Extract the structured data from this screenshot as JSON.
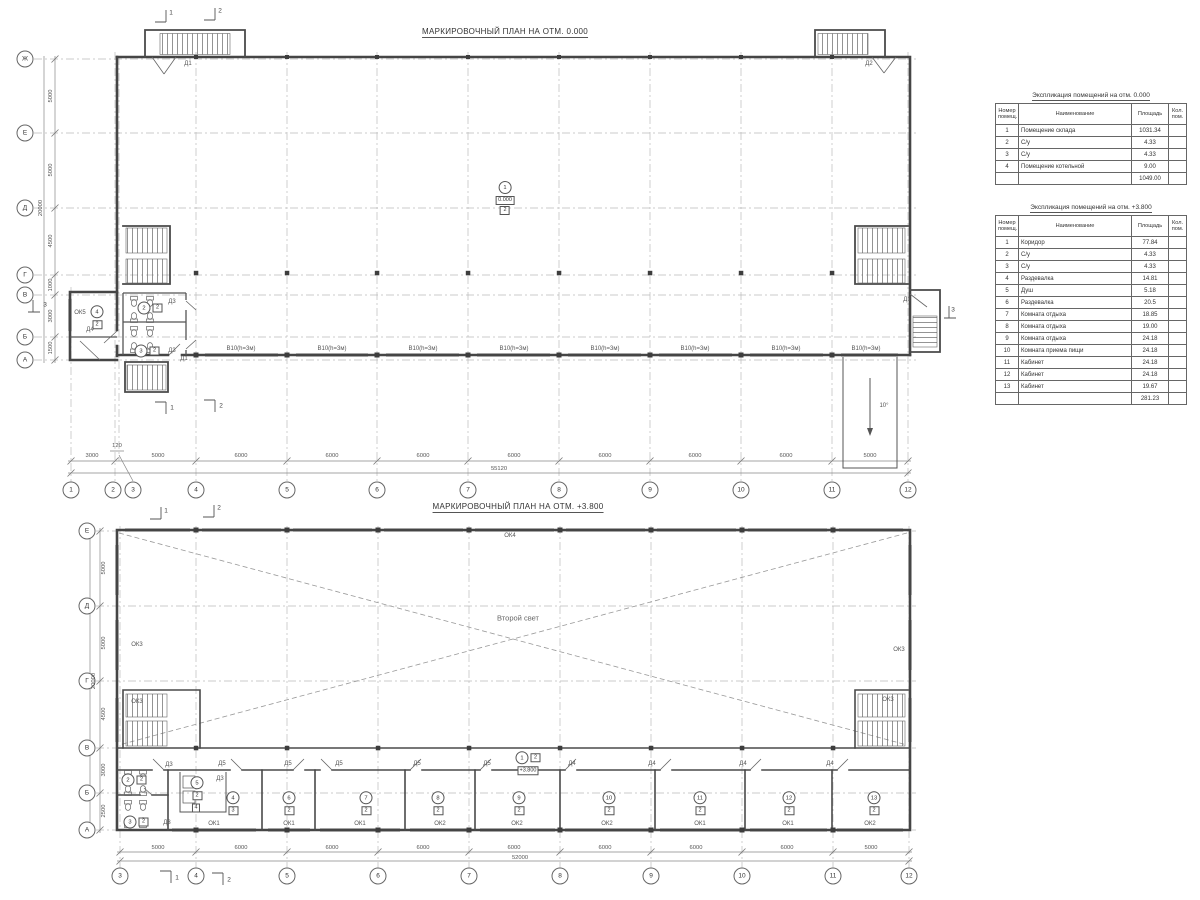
{
  "plan1": {
    "title": "МАРКИРОВОЧНЫЙ ПЛАН НА ОТМ. 0.000",
    "grid_rows": [
      {
        "t": "Ж",
        "x": 25,
        "y": 59
      },
      {
        "t": "Е",
        "x": 25,
        "y": 133
      },
      {
        "t": "Д",
        "x": 25,
        "y": 208
      },
      {
        "t": "Г",
        "x": 25,
        "y": 275
      },
      {
        "t": "В",
        "x": 25,
        "y": 295
      },
      {
        "t": "Б",
        "x": 25,
        "y": 337
      },
      {
        "t": "А",
        "x": 25,
        "y": 360
      }
    ],
    "grid_cols": [
      {
        "t": "1",
        "x": 71,
        "y": 490
      },
      {
        "t": "2",
        "x": 113,
        "y": 490
      },
      {
        "t": "3",
        "x": 133,
        "y": 490
      },
      {
        "t": "4",
        "x": 196,
        "y": 490
      },
      {
        "t": "5",
        "x": 287,
        "y": 490
      },
      {
        "t": "6",
        "x": 377,
        "y": 490
      },
      {
        "t": "7",
        "x": 468,
        "y": 490
      },
      {
        "t": "8",
        "x": 559,
        "y": 490
      },
      {
        "t": "9",
        "x": 650,
        "y": 490
      },
      {
        "t": "10",
        "x": 741,
        "y": 490
      },
      {
        "t": "11",
        "x": 832,
        "y": 490
      },
      {
        "t": "12",
        "x": 908,
        "y": 490
      }
    ],
    "dims_h": [
      {
        "t": "3000",
        "x": 92,
        "y": 456
      },
      {
        "t": "120",
        "x": 117,
        "y": 446
      },
      {
        "t": "5000",
        "x": 158,
        "y": 456
      },
      {
        "t": "6000",
        "x": 241,
        "y": 456
      },
      {
        "t": "6000",
        "x": 332,
        "y": 456
      },
      {
        "t": "6000",
        "x": 423,
        "y": 456
      },
      {
        "t": "6000",
        "x": 514,
        "y": 456
      },
      {
        "t": "6000",
        "x": 605,
        "y": 456
      },
      {
        "t": "6000",
        "x": 695,
        "y": 456
      },
      {
        "t": "6000",
        "x": 786,
        "y": 456
      },
      {
        "t": "5000",
        "x": 870,
        "y": 456
      }
    ],
    "total_h": {
      "t": "55120",
      "x": 499,
      "y": 469
    },
    "dims_v": [
      {
        "t": "5000",
        "x": 51,
        "y": 96
      },
      {
        "t": "5000",
        "x": 51,
        "y": 170
      },
      {
        "t": "4500",
        "x": 51,
        "y": 241
      },
      {
        "t": "1000",
        "x": 51,
        "y": 285
      },
      {
        "t": "3000",
        "x": 51,
        "y": 316
      },
      {
        "t": "1500",
        "x": 51,
        "y": 348
      }
    ],
    "total_v": {
      "t": "20000",
      "x": 41,
      "y": 208
    },
    "labels": [
      {
        "t": "Д1",
        "x": 188,
        "y": 64
      },
      {
        "t": "Д2",
        "x": 869,
        "y": 64
      },
      {
        "t": "Д1",
        "x": 907,
        "y": 300
      },
      {
        "t": "Д1",
        "x": 184,
        "y": 359
      },
      {
        "t": "Д3",
        "x": 172,
        "y": 302
      },
      {
        "t": "Д3",
        "x": 172,
        "y": 351
      },
      {
        "t": "Д4",
        "x": 90,
        "y": 330
      },
      {
        "t": "ОК5",
        "x": 80,
        "y": 313
      },
      {
        "t": "10°",
        "x": 884,
        "y": 406
      },
      {
        "t": "В10(h=3м)",
        "x": 241,
        "y": 349
      },
      {
        "t": "В10(h=3м)",
        "x": 332,
        "y": 349
      },
      {
        "t": "В10(h=3м)",
        "x": 423,
        "y": 349
      },
      {
        "t": "В10(h=3м)",
        "x": 514,
        "y": 349
      },
      {
        "t": "В10(h=3м)",
        "x": 605,
        "y": 349
      },
      {
        "t": "В10(h=3м)",
        "x": 695,
        "y": 349
      },
      {
        "t": "В10(h=3м)",
        "x": 786,
        "y": 349
      },
      {
        "t": "В10(h=3м)",
        "x": 866,
        "y": 349
      }
    ],
    "flags": [
      {
        "t": "1",
        "x": 171,
        "y": 13
      },
      {
        "t": "2",
        "x": 220,
        "y": 11
      },
      {
        "t": "1",
        "x": 172,
        "y": 408
      },
      {
        "t": "2",
        "x": 221,
        "y": 406
      },
      {
        "t": "3",
        "x": 45,
        "y": 305
      },
      {
        "t": "3",
        "x": 953,
        "y": 310
      }
    ],
    "marks_v": [
      {
        "num": "4",
        "sub": "2",
        "x": 97,
        "y": 317
      }
    ],
    "marks_h": [
      {
        "num": "2",
        "sub": "2",
        "x": 150,
        "y": 308
      },
      {
        "num": "3",
        "sub": "2",
        "x": 147,
        "y": 351
      }
    ],
    "mark": {
      "num": "1",
      "elev": "0.000",
      "sub": "2"
    }
  },
  "plan2": {
    "title": "МАРКИРОВОЧНЫЙ ПЛАН НА ОТМ. +3.800",
    "grid_rows": [
      {
        "t": "Е",
        "x": 87,
        "y": 531
      },
      {
        "t": "Д",
        "x": 87,
        "y": 606
      },
      {
        "t": "Г",
        "x": 87,
        "y": 681
      },
      {
        "t": "В",
        "x": 87,
        "y": 748
      },
      {
        "t": "Б",
        "x": 87,
        "y": 793
      },
      {
        "t": "А",
        "x": 87,
        "y": 830
      }
    ],
    "grid_cols": [
      {
        "t": "3",
        "x": 120,
        "y": 876
      },
      {
        "t": "4",
        "x": 196,
        "y": 876
      },
      {
        "t": "5",
        "x": 287,
        "y": 876
      },
      {
        "t": "6",
        "x": 378,
        "y": 876
      },
      {
        "t": "7",
        "x": 469,
        "y": 876
      },
      {
        "t": "8",
        "x": 560,
        "y": 876
      },
      {
        "t": "9",
        "x": 651,
        "y": 876
      },
      {
        "t": "10",
        "x": 742,
        "y": 876
      },
      {
        "t": "11",
        "x": 833,
        "y": 876
      },
      {
        "t": "12",
        "x": 909,
        "y": 876
      }
    ],
    "dims_h": [
      {
        "t": "5000",
        "x": 158,
        "y": 848
      },
      {
        "t": "6000",
        "x": 241,
        "y": 848
      },
      {
        "t": "6000",
        "x": 332,
        "y": 848
      },
      {
        "t": "6000",
        "x": 423,
        "y": 848
      },
      {
        "t": "6000",
        "x": 514,
        "y": 848
      },
      {
        "t": "6000",
        "x": 605,
        "y": 848
      },
      {
        "t": "6000",
        "x": 696,
        "y": 848
      },
      {
        "t": "6000",
        "x": 787,
        "y": 848
      },
      {
        "t": "5000",
        "x": 871,
        "y": 848
      }
    ],
    "total_h": {
      "t": "52000",
      "x": 520,
      "y": 858
    },
    "dims_v": [
      {
        "t": "5000",
        "x": 104,
        "y": 568
      },
      {
        "t": "5000",
        "x": 104,
        "y": 643
      },
      {
        "t": "4500",
        "x": 104,
        "y": 714
      },
      {
        "t": "3000",
        "x": 104,
        "y": 770
      },
      {
        "t": "2500",
        "x": 104,
        "y": 811
      }
    ],
    "total_v": {
      "t": "20000",
      "x": 94,
      "y": 681
    },
    "labels": [
      {
        "t": "ОК4",
        "x": 510,
        "y": 536
      },
      {
        "t": "ОК3",
        "x": 137,
        "y": 645
      },
      {
        "t": "ОК3",
        "x": 137,
        "y": 702
      },
      {
        "t": "ОК3",
        "x": 888,
        "y": 700
      },
      {
        "t": "ОК3",
        "x": 899,
        "y": 650
      },
      {
        "t": "Д3",
        "x": 169,
        "y": 765
      },
      {
        "t": "Д3",
        "x": 220,
        "y": 779
      },
      {
        "t": "Д3",
        "x": 167,
        "y": 823
      },
      {
        "t": "Д5",
        "x": 222,
        "y": 764
      },
      {
        "t": "Д5",
        "x": 288,
        "y": 764
      },
      {
        "t": "Д5",
        "x": 339,
        "y": 764
      },
      {
        "t": "Д5",
        "x": 417,
        "y": 764
      },
      {
        "t": "Д5",
        "x": 487,
        "y": 764
      },
      {
        "t": "Д4",
        "x": 572,
        "y": 764
      },
      {
        "t": "Д4",
        "x": 652,
        "y": 764
      },
      {
        "t": "Д4",
        "x": 743,
        "y": 764
      },
      {
        "t": "Д4",
        "x": 830,
        "y": 764
      },
      {
        "t": "ОК1",
        "x": 214,
        "y": 824
      },
      {
        "t": "ОК1",
        "x": 289,
        "y": 824
      },
      {
        "t": "ОК1",
        "x": 360,
        "y": 824
      },
      {
        "t": "ОК2",
        "x": 440,
        "y": 824
      },
      {
        "t": "ОК2",
        "x": 517,
        "y": 824
      },
      {
        "t": "ОК2",
        "x": 607,
        "y": 824
      },
      {
        "t": "ОК1",
        "x": 700,
        "y": 824
      },
      {
        "t": "ОК1",
        "x": 788,
        "y": 824
      },
      {
        "t": "ОК2",
        "x": 870,
        "y": 824
      }
    ],
    "big_label": {
      "t": "Второй свет",
      "x": 518,
      "y": 618
    },
    "flags": [
      {
        "t": "1",
        "x": 166,
        "y": 511
      },
      {
        "t": "2",
        "x": 219,
        "y": 508
      },
      {
        "t": "1",
        "x": 177,
        "y": 878
      },
      {
        "t": "2",
        "x": 229,
        "y": 880
      }
    ],
    "marks_v": [
      {
        "num": "5",
        "sub": "2",
        "x": 197,
        "y": 788
      },
      {
        "num": "4",
        "sub": "3",
        "x": 233,
        "y": 803
      },
      {
        "num": "6",
        "sub": "2",
        "x": 289,
        "y": 803
      },
      {
        "num": "7",
        "sub": "2",
        "x": 366,
        "y": 803
      },
      {
        "num": "8",
        "sub": "2",
        "x": 438,
        "y": 803
      },
      {
        "num": "9",
        "sub": "2",
        "x": 519,
        "y": 803
      },
      {
        "num": "10",
        "sub": "2",
        "x": 609,
        "y": 803
      },
      {
        "num": "11",
        "sub": "2",
        "x": 700,
        "y": 803
      },
      {
        "num": "12",
        "sub": "2",
        "x": 789,
        "y": 803
      },
      {
        "num": "13",
        "sub": "2",
        "x": 874,
        "y": 803
      }
    ],
    "marks_h": [
      {
        "num": "2",
        "sub": "2",
        "x": 134,
        "y": 780
      },
      {
        "num": "3",
        "sub": "2",
        "x": 136,
        "y": 822
      }
    ],
    "boxes": [
      {
        "t": "4",
        "x": 196,
        "y": 808
      }
    ],
    "mark": {
      "num": "1",
      "sub": "2",
      "elev": "+3.800"
    }
  },
  "tables": [
    {
      "title": "Экспликация помещений на отм. 0.000",
      "headers": [
        "Номер помещ.",
        "Наименование",
        "Площадь",
        "Кол. пом."
      ],
      "rows": [
        [
          "1",
          "Помещение склада",
          "1031.34",
          ""
        ],
        [
          "2",
          "С/у",
          "4.33",
          ""
        ],
        [
          "3",
          "С/у",
          "4.33",
          ""
        ],
        [
          "4",
          "Помещение котельной",
          "9.00",
          ""
        ]
      ],
      "total": "1049.00"
    },
    {
      "title": "Экспликация помещений на отм. +3.800",
      "headers": [
        "Номер помещ.",
        "Наименование",
        "Площадь",
        "Кол. пом."
      ],
      "rows": [
        [
          "1",
          "Коридор",
          "77.84",
          ""
        ],
        [
          "2",
          "С/у",
          "4.33",
          ""
        ],
        [
          "3",
          "С/у",
          "4.33",
          ""
        ],
        [
          "4",
          "Раздевалка",
          "14.81",
          ""
        ],
        [
          "5",
          "Душ",
          "5.18",
          ""
        ],
        [
          "6",
          "Раздевалка",
          "20.5",
          ""
        ],
        [
          "7",
          "Комната отдыха",
          "18.85",
          ""
        ],
        [
          "8",
          "Комната отдыха",
          "19.00",
          ""
        ],
        [
          "9",
          "Комната отдыха",
          "24.18",
          ""
        ],
        [
          "10",
          "Комната приема пищи",
          "24.18",
          ""
        ],
        [
          "11",
          "Кабинет",
          "24.18",
          ""
        ],
        [
          "12",
          "Кабинет",
          "24.18",
          ""
        ],
        [
          "13",
          "Кабинет",
          "19.67",
          ""
        ]
      ],
      "total": "281.23"
    }
  ]
}
